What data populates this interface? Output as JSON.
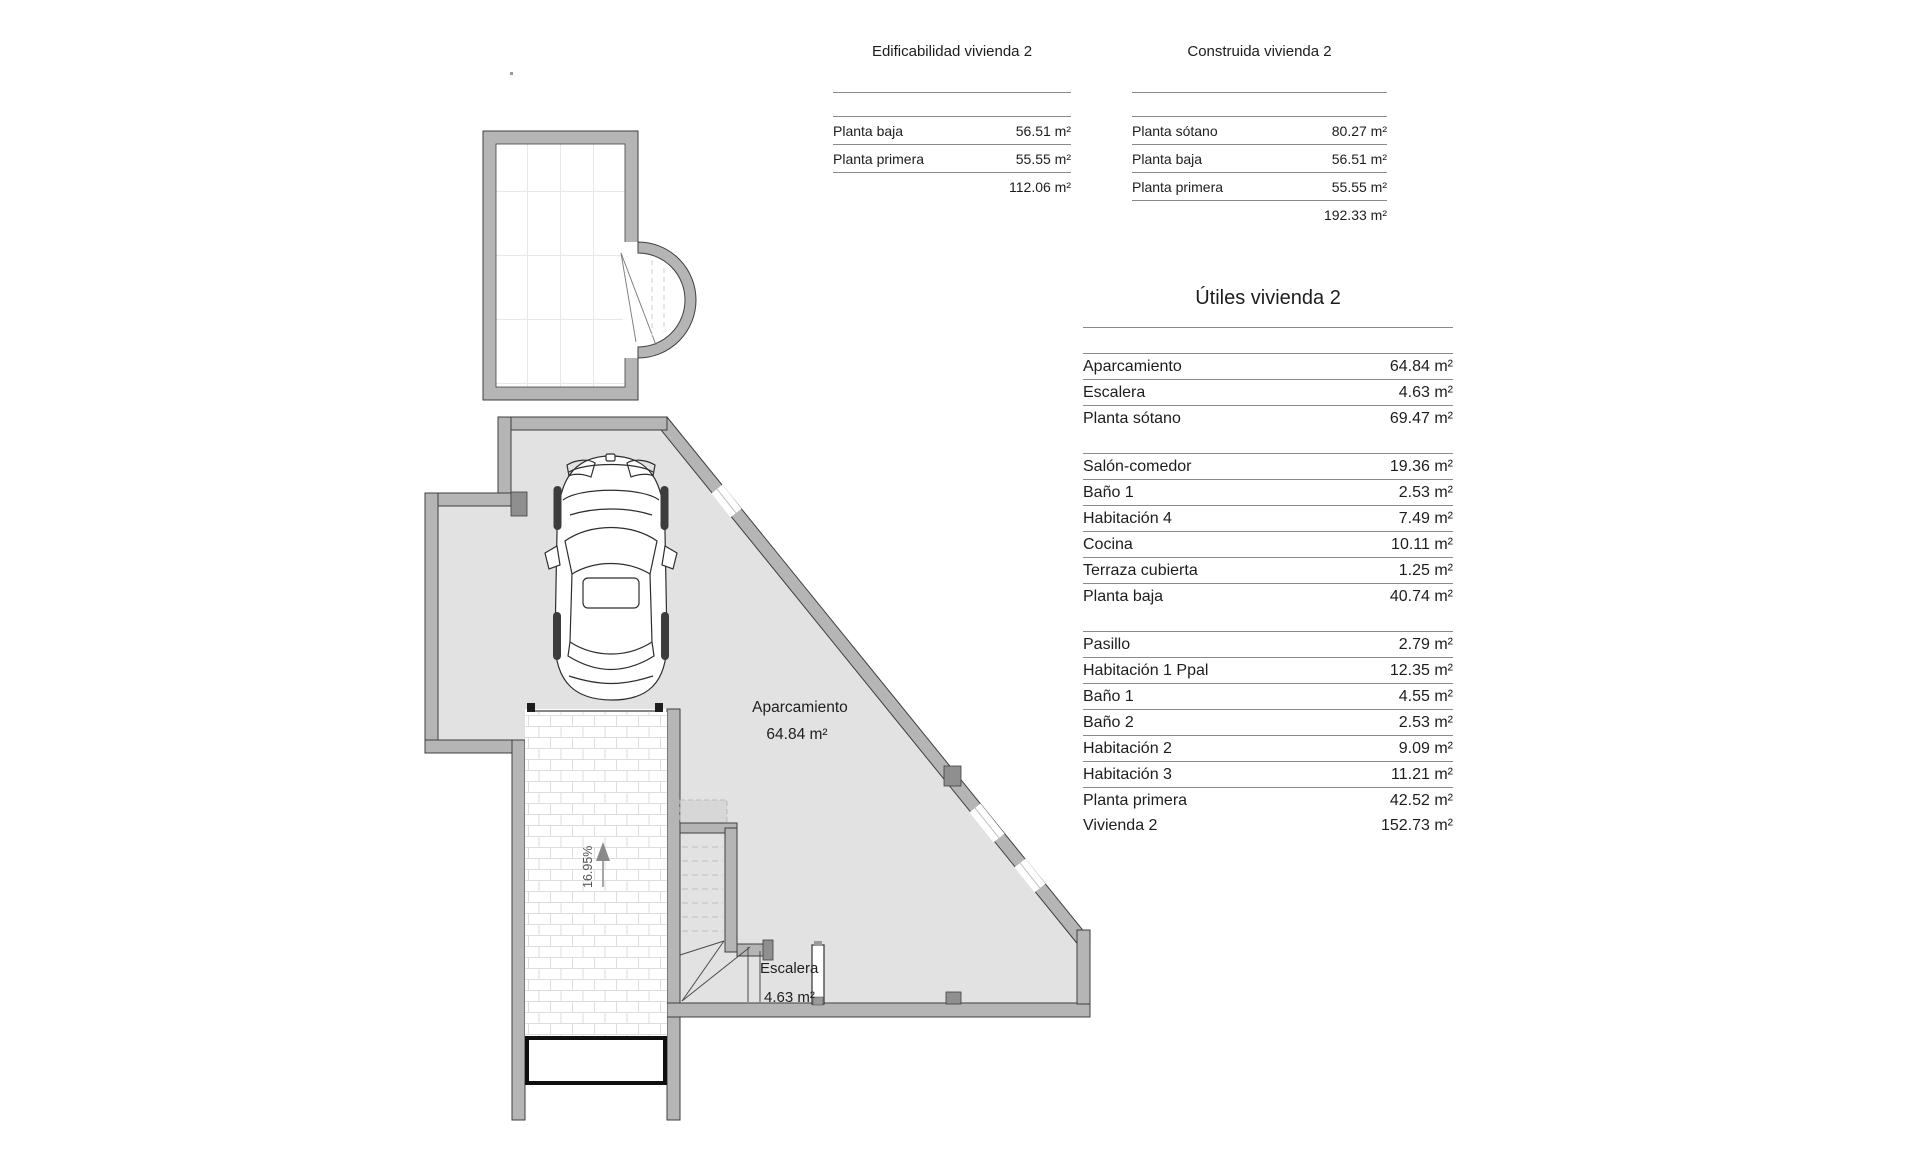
{
  "tables": {
    "edificabilidad": {
      "title": "Edificabilidad vivienda 2",
      "rows": [
        [
          "Planta baja",
          "56.51 m²"
        ],
        [
          "Planta primera",
          "55.55 m²"
        ]
      ],
      "total": "112.06 m²"
    },
    "construida": {
      "title": "Construida vivienda 2",
      "rows": [
        [
          "Planta sótano",
          "80.27 m²"
        ],
        [
          "Planta baja",
          "56.51 m²"
        ],
        [
          "Planta primera",
          "55.55 m²"
        ]
      ],
      "total": "192.33 m²"
    },
    "utiles": {
      "title": "Útiles vivienda 2",
      "groups": [
        {
          "rows": [
            [
              "Aparcamiento",
              "64.84 m²"
            ],
            [
              "Escalera",
              "4.63 m²"
            ]
          ],
          "totals": [
            [
              "Planta sótano",
              "69.47 m²"
            ]
          ]
        },
        {
          "rows": [
            [
              "Salón-comedor",
              "19.36 m²"
            ],
            [
              "Baño 1",
              "2.53 m²"
            ],
            [
              "Habitación 4",
              "7.49 m²"
            ],
            [
              "Cocina",
              "10.11 m²"
            ],
            [
              "Terraza cubierta",
              "1.25 m²"
            ]
          ],
          "totals": [
            [
              "Planta baja",
              "40.74 m²"
            ]
          ]
        },
        {
          "rows": [
            [
              "Pasillo",
              "2.79 m²"
            ],
            [
              "Habitación 1 Ppal",
              "12.35 m²"
            ],
            [
              "Baño 1",
              "4.55 m²"
            ],
            [
              "Baño 2",
              "2.53 m²"
            ],
            [
              "Habitación 2",
              "9.09 m²"
            ],
            [
              "Habitación 3",
              "11.21 m²"
            ]
          ],
          "totals": [
            [
              "Planta primera",
              "42.52 m²"
            ],
            [
              "Vivienda 2",
              "152.73 m²"
            ]
          ]
        }
      ]
    }
  },
  "plan": {
    "labels": {
      "aparcamiento": "Aparcamiento",
      "aparcamiento_area": "64.84 m²",
      "escalera": "Escalera",
      "escalera_area": "4.63 m²",
      "ramp_slope": "16.95%"
    },
    "colors": {
      "wall": "#b5b5b5",
      "floor": "#e2e2e2",
      "outline": "#3f3f3f",
      "pillar": "#8f8f8f",
      "rule": "#8a8a8a",
      "hatch": "#dddddd"
    }
  }
}
